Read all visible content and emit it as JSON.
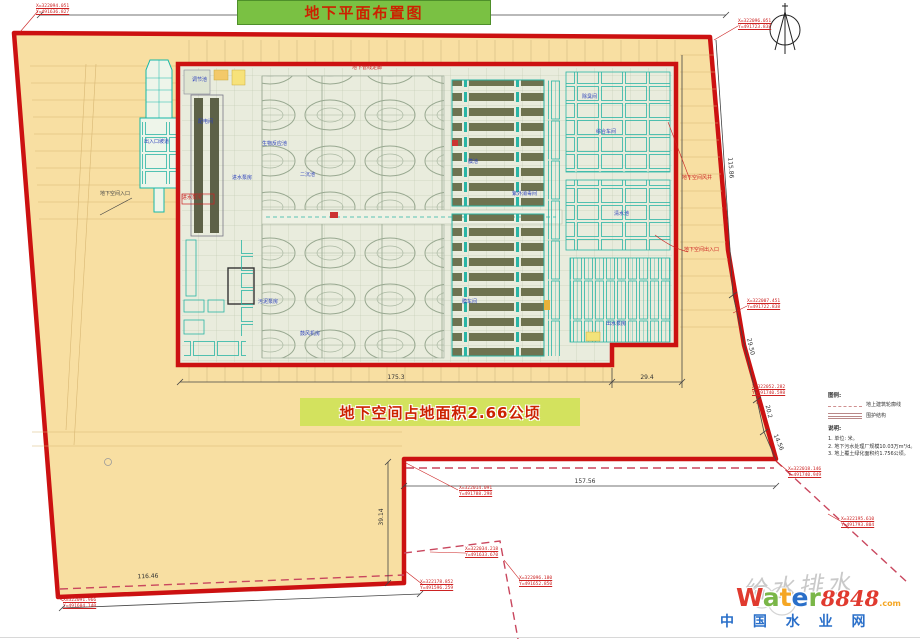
{
  "title": "地下平面布置图",
  "area_label": "地下空间占地面积2.66公顷",
  "dims": {
    "bottom_main": "175.3",
    "bottom_ext": "29.4",
    "notch_width": "157.56",
    "notch_height": "39.14",
    "bottom_left": "116.46",
    "right_upper": "115.86",
    "right_mid": "29.50",
    "right_low1": "20.2",
    "right_low2": "14.56"
  },
  "coords": [
    {
      "x": "X=322094.051",
      "y": "Y=491636.827"
    },
    {
      "x": "X=322096.051",
      "y": "Y=491723.838"
    },
    {
      "x": "X=322007.451",
      "y": "Y=491722.838"
    },
    {
      "x": "X=322052.282",
      "y": "Y=491740.598"
    },
    {
      "x": "X=322018.146",
      "y": "Y=491740.949"
    },
    {
      "x": "X=322195.610",
      "y": "Y=491793.804"
    },
    {
      "x": "X=322014.091",
      "y": "Y=491788.298"
    },
    {
      "x": "X=322034.218",
      "y": "Y=491633.670"
    },
    {
      "x": "X=322096.180",
      "y": "Y=491652.850"
    },
    {
      "x": "X=322178.852",
      "y": "Y=491596.259"
    },
    {
      "x": "X=322091.966",
      "y": "Y=491604.140"
    }
  ],
  "legend": {
    "heading": "图例:",
    "items": [
      "地上建筑轮廓线",
      "围护结构"
    ],
    "notes_heading": "说明:",
    "notes": [
      "1. 单位: 米。",
      "2. 地下污水处理厂规模10.03万m³/d。",
      "3. 地上覆土绿化面积约1.756公顷。"
    ]
  },
  "site_labels": {
    "entrance_left": "地下空间入口",
    "vent_shaft": "地下空间风井",
    "entrance_right": "地下空间出入口"
  },
  "plant_labels": [
    "调节池",
    "配电间",
    "进水泵房",
    "生物反应池",
    "二沉池",
    "污泥泵房",
    "鼓风机房",
    "膜池",
    "膜车间",
    "紫外消毒间",
    "综合车间",
    "清水池",
    "出水泵房",
    "除臭间",
    "地下管线走廊",
    "出入口坡道"
  ],
  "watermark": {
    "script": "给水排水",
    "word": [
      "W",
      "a",
      "t",
      "e",
      "r"
    ],
    "num": "8848",
    "tld": ".com",
    "cn": "中 国 水 业 网"
  },
  "colors": {
    "site": "#f8dfa2",
    "boundary": "#cc1111",
    "title_bg": "#7ac143",
    "area_bg": "#d3e25e",
    "text_red": "#cc2200",
    "watermark_blue": "#2a6fc9"
  }
}
